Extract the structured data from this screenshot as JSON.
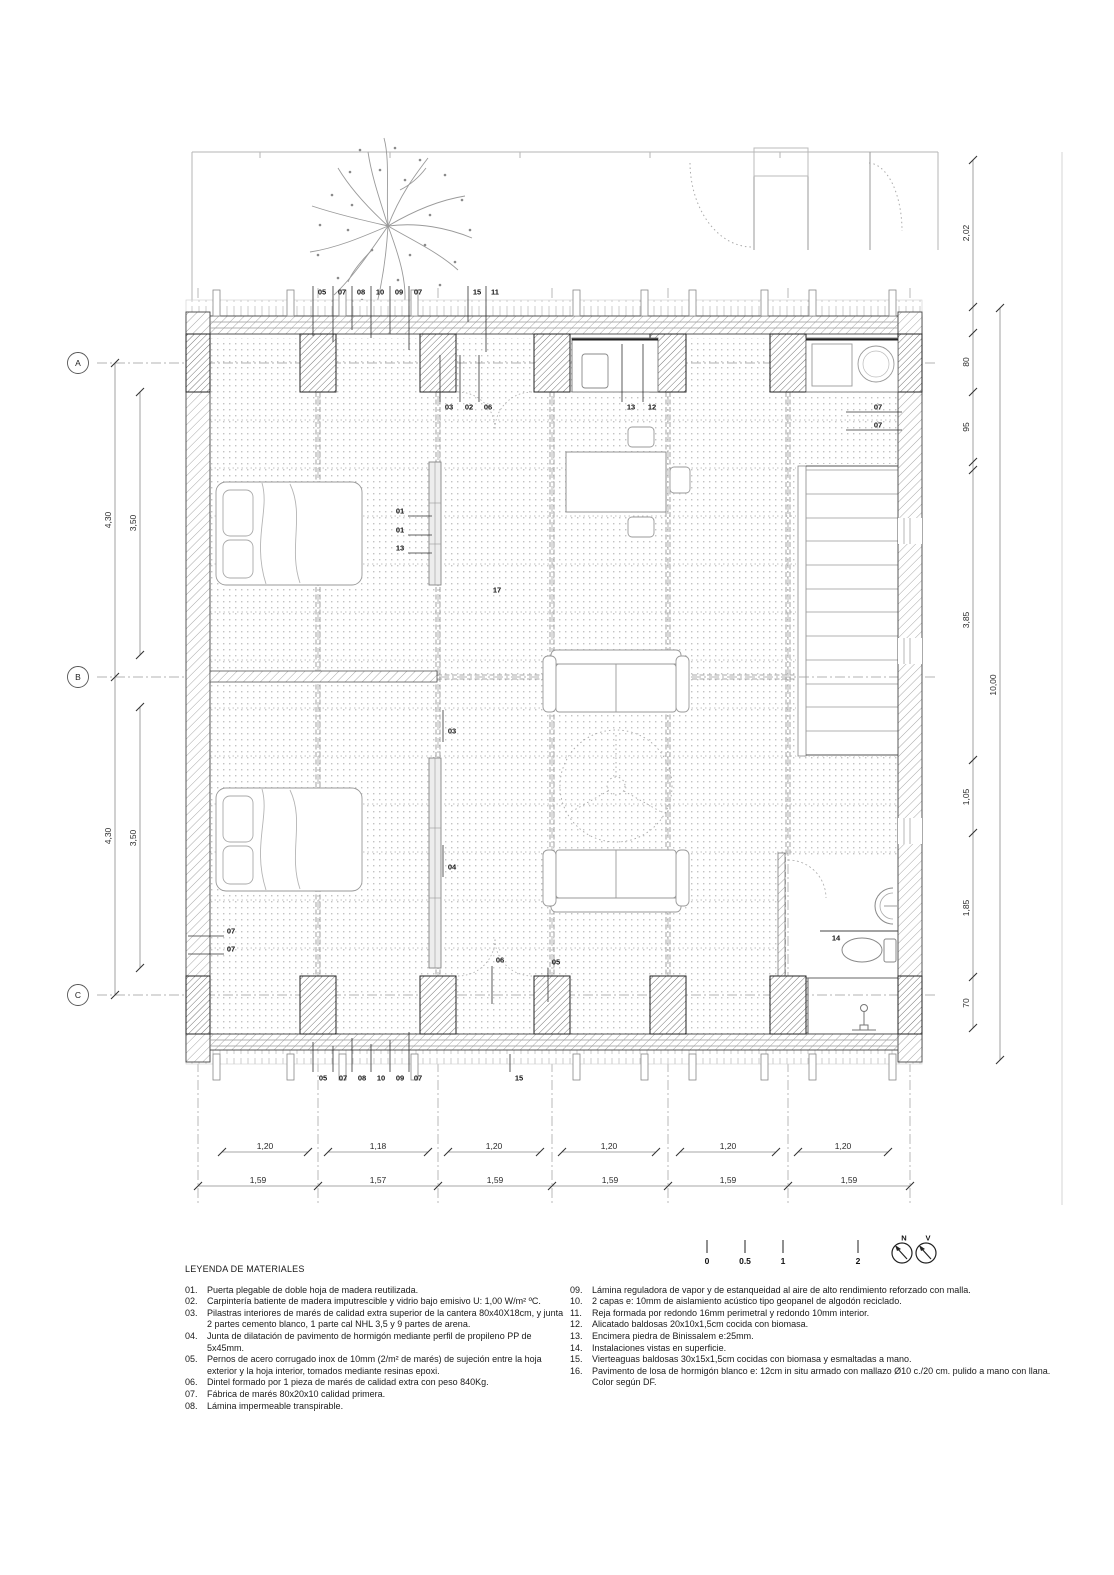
{
  "grid": {
    "rows": [
      "A",
      "B",
      "C"
    ]
  },
  "callouts": {
    "top": [
      "05",
      "07",
      "08",
      "10",
      "09",
      "07",
      "15",
      "11"
    ],
    "bottom": [
      "05",
      "07",
      "08",
      "10",
      "09",
      "07",
      "15"
    ],
    "plan": [
      "03",
      "02",
      "06",
      "13",
      "12",
      "07",
      "07",
      "01",
      "01",
      "13",
      "17",
      "03",
      "04",
      "07",
      "07",
      "06",
      "05",
      "14"
    ]
  },
  "dimensions": {
    "left_outer": [
      "4,30",
      "4,30"
    ],
    "left_inner": [
      "3,50",
      "3,50"
    ],
    "right_chain": [
      "2,02",
      "80",
      "95",
      "3,85",
      "1,05",
      "1,85",
      "70"
    ],
    "right_total": "10,00",
    "bottom_inner": [
      "1,20",
      "1,18",
      "1,20",
      "1,20",
      "1,20",
      "1,20"
    ],
    "bottom_outer": [
      "1,59",
      "1,57",
      "1,59",
      "1,59",
      "1,59",
      "1,59"
    ]
  },
  "scalebar": {
    "ticks": [
      "0",
      "0.5",
      "1",
      "2"
    ],
    "north_label": "N",
    "vertical_label": "V"
  },
  "legend": {
    "title": "LEYENDA DE MATERIALES",
    "left": [
      {
        "num": "01.",
        "text": "Puerta plegable de doble hoja de madera reutilizada."
      },
      {
        "num": "02.",
        "text": "Carpintería batiente de madera imputrescible y vidrio bajo emisivo U: 1,00 W/m² ºC."
      },
      {
        "num": "03.",
        "text": "Pilastras interiores de marés de calidad extra superior de la cantera 80x40X18cm, y junta 2 partes cemento blanco, 1 parte cal NHL 3,5 y 9 partes de arena."
      },
      {
        "num": "04.",
        "text": "Junta de dilatación de pavimento de hormigón mediante perfil de propileno PP de 5x45mm."
      },
      {
        "num": "05.",
        "text": "Pernos de acero corrugado inox de 10mm (2/m² de marés) de sujeción entre la hoja exterior y la hoja interior, tomados mediante resinas epoxi."
      },
      {
        "num": "06.",
        "text": "Dintel formado por 1 pieza de marés de calidad extra con peso 840Kg."
      },
      {
        "num": "07.",
        "text": "Fábrica de marés 80x20x10 calidad primera."
      },
      {
        "num": "08.",
        "text": "Lámina impermeable transpirable."
      }
    ],
    "right": [
      {
        "num": "09.",
        "text": "Lámina reguladora de vapor y de estanqueidad al aire de alto rendimiento reforzado con malla."
      },
      {
        "num": "10.",
        "text": "2 capas e: 10mm de aislamiento acústico tipo geopanel de algodón reciclado."
      },
      {
        "num": "11.",
        "text": "Reja formada por redondo 16mm perimetral y redondo 10mm interior."
      },
      {
        "num": "12.",
        "text": "Alicatado baldosas 20x10x1,5cm cocida con biomasa."
      },
      {
        "num": "13.",
        "text": "Encimera piedra de Binissalem e:25mm."
      },
      {
        "num": "14.",
        "text": "Instalaciones vistas en superficie."
      },
      {
        "num": "15.",
        "text": "Vierteaguas baldosas 30x15x1,5cm cocidas con biomasa y esmaltadas a mano."
      },
      {
        "num": "16.",
        "text": "Pavimento de losa de hormigón blanco e: 12cm in situ armado con mallazo Ø10 c./20 cm. pulido a mano con llana. Color según DF."
      }
    ]
  }
}
